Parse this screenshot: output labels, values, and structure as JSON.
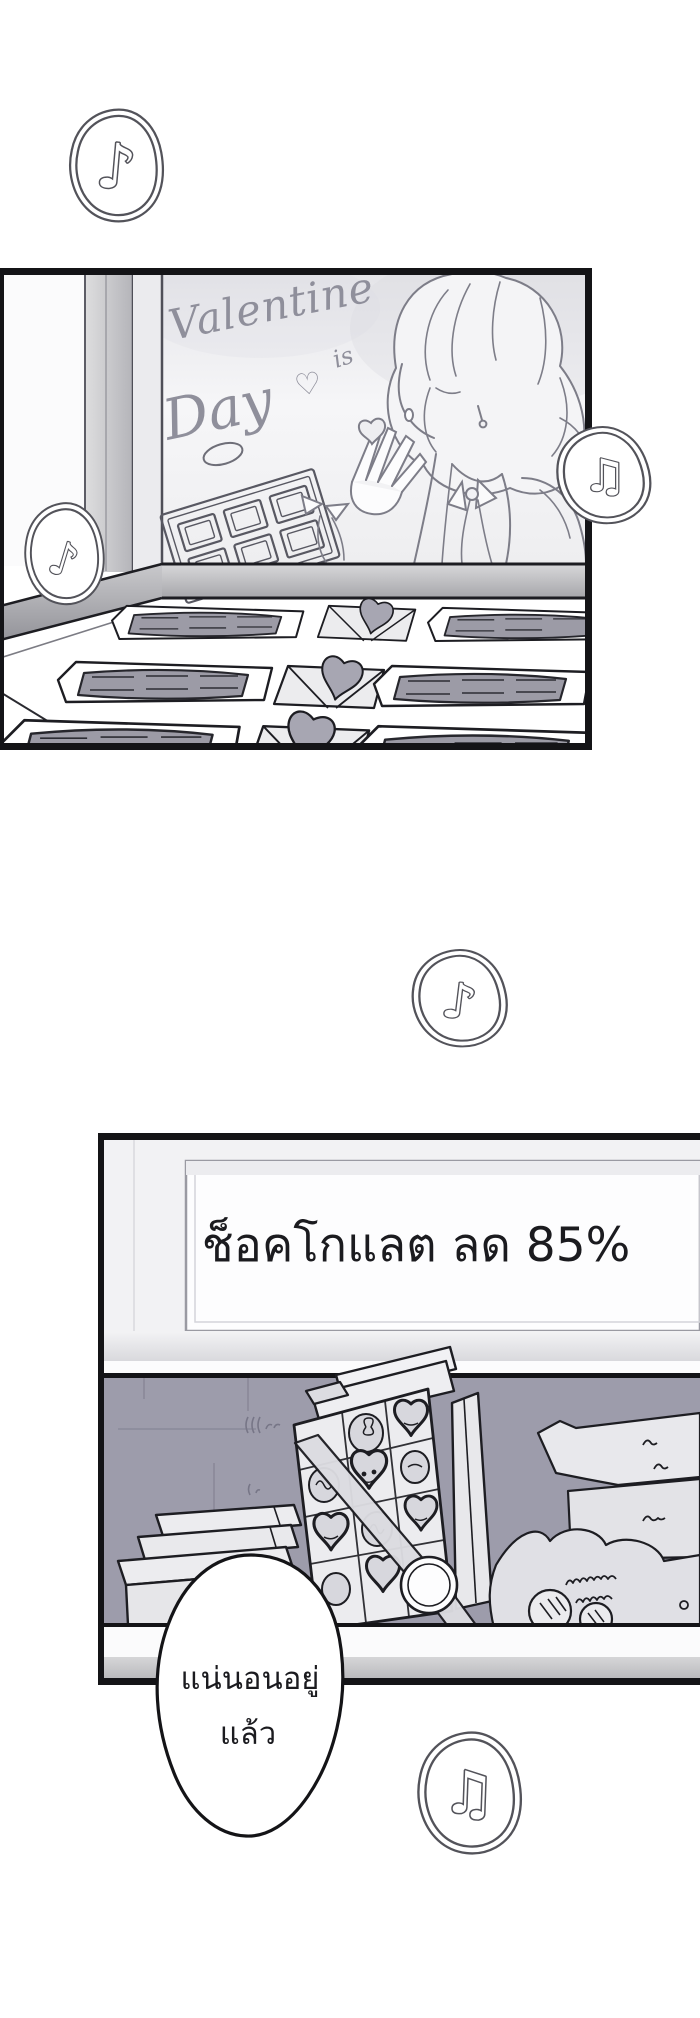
{
  "page": {
    "kind": "webtoon-comic-page",
    "background": "#ffffff"
  },
  "panel_valentine": {
    "poster": {
      "word_valentine": "Valentine",
      "word_is": "is",
      "word_day": "Day",
      "heart": "♡"
    }
  },
  "panel_sale": {
    "sign_text": "ช็อคโกแลต ลด 85%"
  },
  "speech_bubble": {
    "line1": "แน่นอนอยู่",
    "line2": "แล้ว"
  },
  "music_bubbles": [
    {
      "note": "♪"
    },
    {
      "note": "♫"
    },
    {
      "note": "♪"
    },
    {
      "note": "♪"
    },
    {
      "note": "♫"
    }
  ],
  "colors": {
    "panel_border": "#141417",
    "sketch_line": "#83838d",
    "script_gray": "#8f8f9b",
    "shelf_gray": "#aeaeb2",
    "chocolate_gray": "#9c9ba6",
    "heart_gray": "#a7a6b2",
    "wall_dark": "#9d9cab",
    "bubble_outline": "#53535a",
    "sign_text_color": "#1b1b1f"
  }
}
